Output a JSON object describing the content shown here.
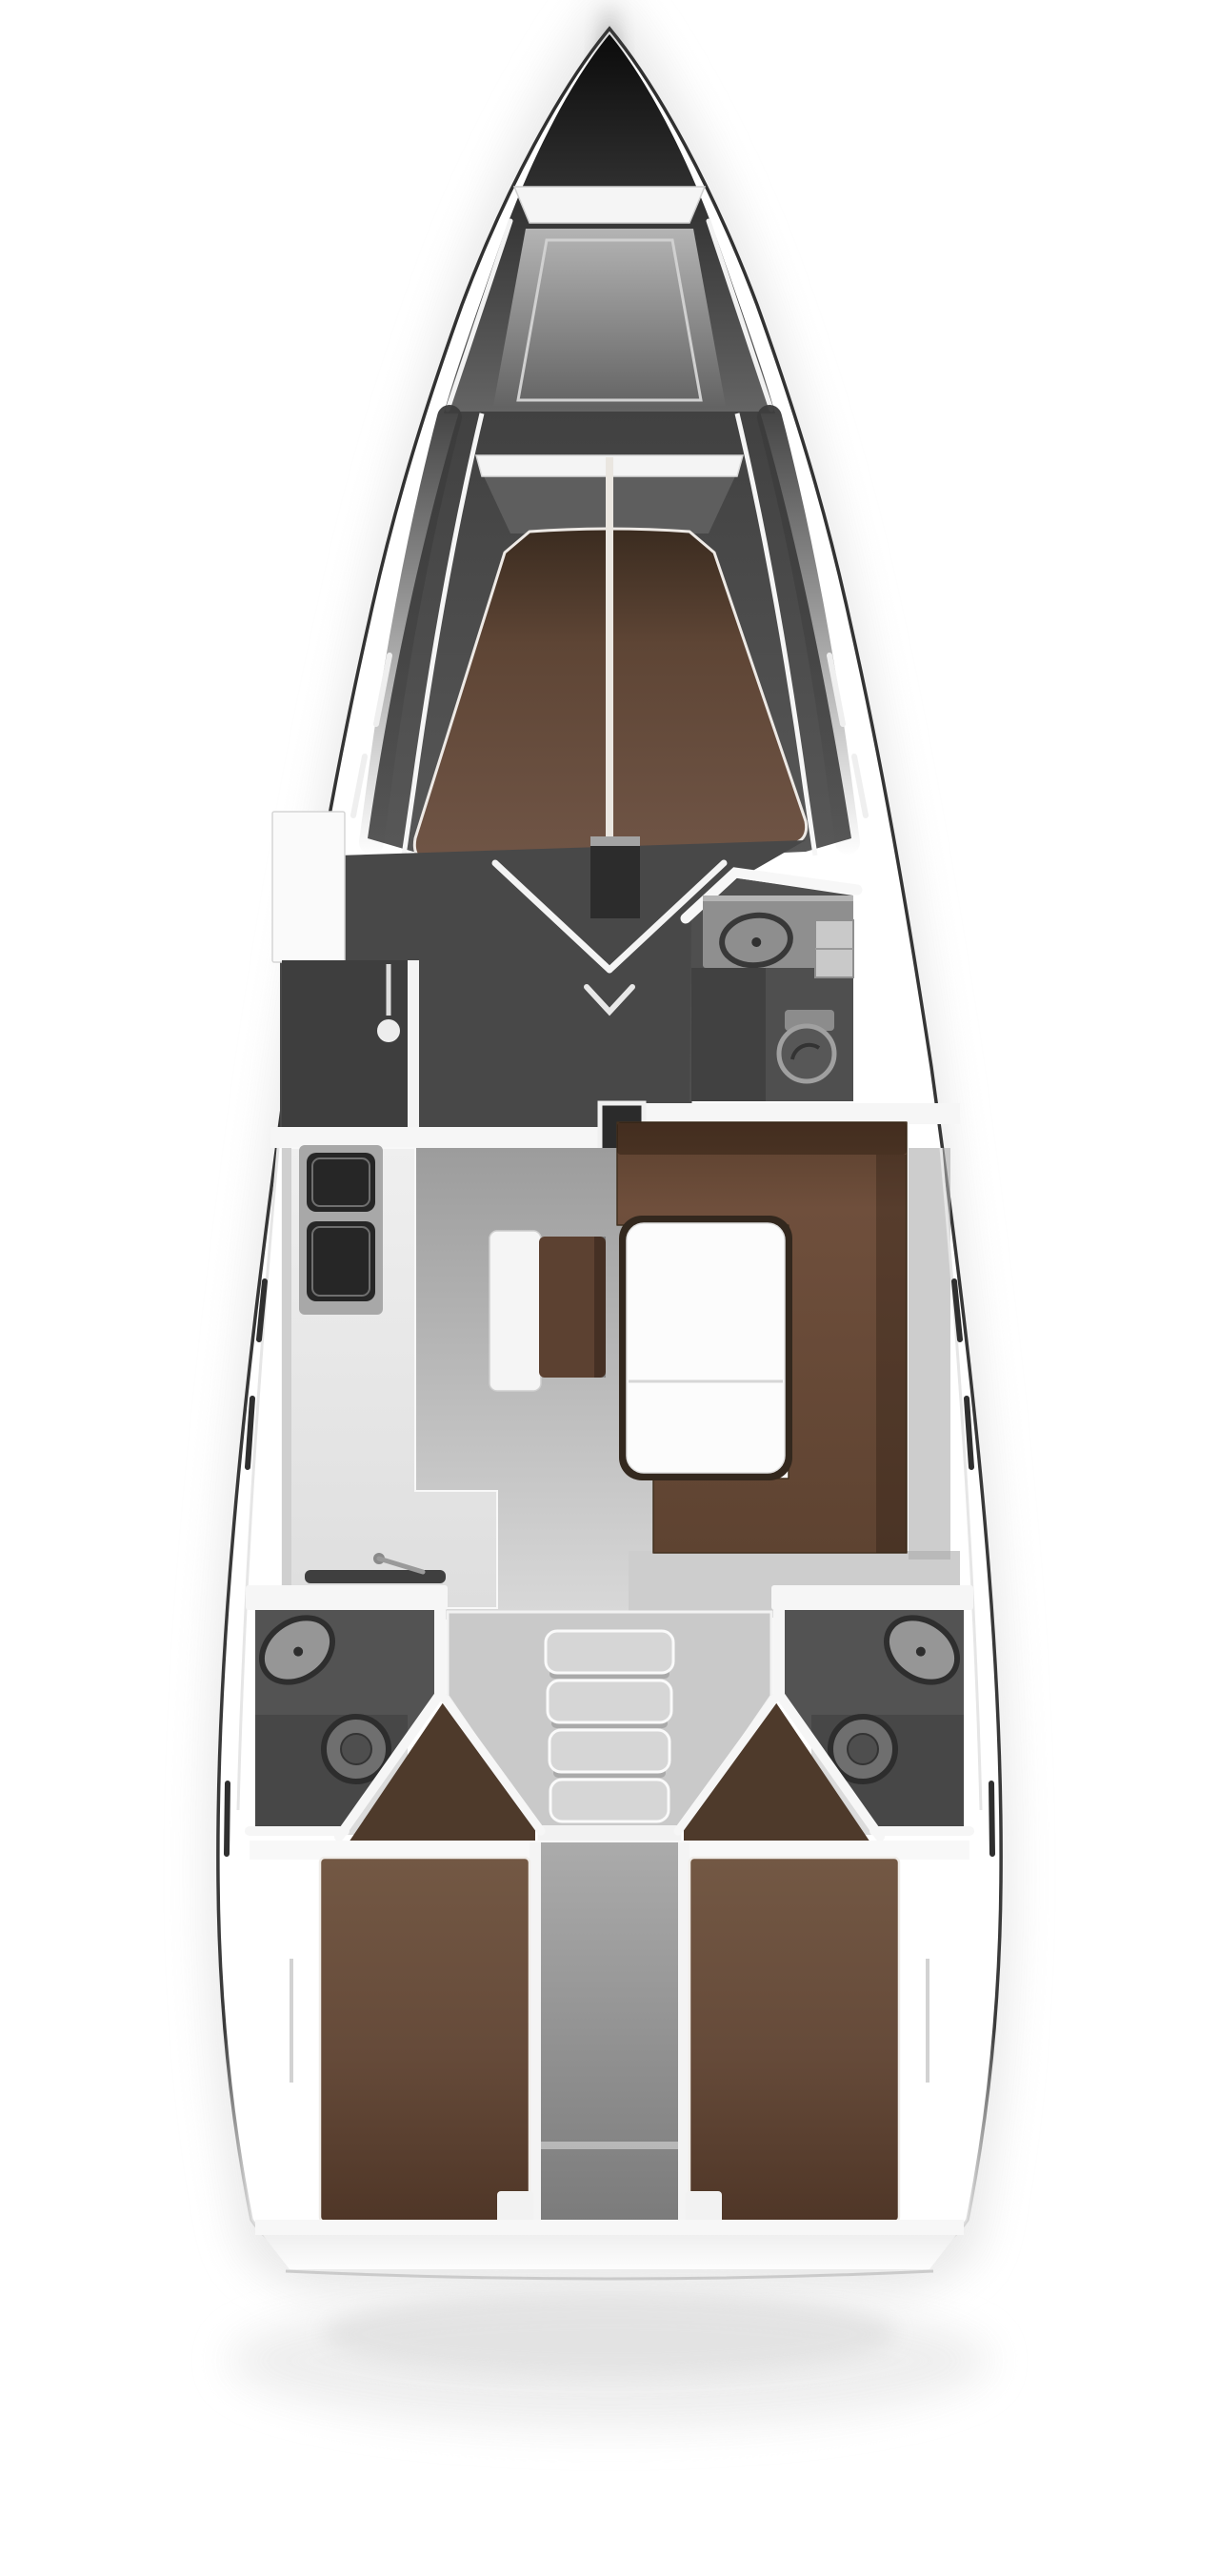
{
  "meta": {
    "type": "yacht-interior-floor-plan",
    "view": "top-down",
    "orientation": "bow-up"
  },
  "colors": {
    "background": "#ffffff",
    "hull_line": "#303030",
    "bow_dark": "#0b0b0b",
    "bow_fade": "#656565",
    "locker_top": "#b4b4b4",
    "locker_bottom": "#636363",
    "wall_white": "#f6f6f6",
    "cabin_dark_top": "#414141",
    "cabin_dark_bottom": "#585858",
    "mid_floor_dark": "#484848",
    "closet_dark": "#3e3e3e",
    "head_interior": "#4f4f4f",
    "aft_head_interior": "#535353",
    "fwd_berth_top": "#3a2b1f",
    "fwd_berth_mid": "#5e4535",
    "fwd_berth_bottom": "#705546",
    "berth_seam": "#eae6e0",
    "floor_top": "#9c9c9c",
    "floor_bottom": "#d9d9d9",
    "counter_top": "#efefef",
    "counter_bottom": "#dedede",
    "stove_dark": "#262626",
    "settee_top": "#5a3f2d",
    "settee_mid": "#6f4f3c",
    "settee_bottom": "#5e4331",
    "table_frame": "#33281e",
    "table_top": "#fcfcfc",
    "bench_white": "#f5f5f5",
    "bench_brown": "#5c4131",
    "bay_floor": "#c9c9c9",
    "step_gray": "#d6d6d6",
    "corridor_top": "#ababab",
    "corridor_bottom": "#7b7b7b",
    "aft_berth_top": "#735844",
    "aft_berth_mid": "#654a39",
    "aft_berth_bottom": "#4f3627",
    "entry_brown": "#4e3a2b",
    "fixture_ring": "#2d2d2d",
    "fixture_fill": "#8e8e8e",
    "toilet_fill": "#6f6f6f",
    "window_dark": "#2f2f2f",
    "window_light": "#efefef",
    "transom_line": "#c6c6c6",
    "soft_shadow": "#e8e8e8"
  },
  "regions": {
    "bow": {
      "name": "bow with windlass plate and anchor locker"
    },
    "forward_cabin": {
      "name": "forward cabin",
      "berth": "V-shaped island double berth with center seam",
      "wardrobe": "port wardrobe",
      "hanging_locker": "port hanging locker with hanger symbol"
    },
    "forward_head": {
      "name": "forward head (starboard)",
      "fixtures": [
        "sink",
        "vanity-cabinet",
        "toilet"
      ]
    },
    "saloon": {
      "name": "saloon",
      "furniture": [
        "L-shaped settee (starboard)",
        "folding table",
        "center bench seat"
      ]
    },
    "galley": {
      "name": "galley (port)",
      "fixtures": [
        "two-burner stove",
        "sink",
        "faucet"
      ]
    },
    "companionway": {
      "name": "companionway",
      "step_count": 4
    },
    "aft_head_port": {
      "name": "aft head (port)",
      "fixtures": [
        "sink",
        "toilet"
      ]
    },
    "aft_head_starboard": {
      "name": "aft head (starboard)",
      "fixtures": [
        "sink",
        "toilet"
      ]
    },
    "aft_cabin_port": {
      "name": "aft cabin (port)",
      "berth": "double berth"
    },
    "aft_cabin_starboard": {
      "name": "aft cabin (starboard)",
      "berth": "double berth"
    },
    "engine_corridor": {
      "name": "center corridor / engine compartment"
    },
    "stern": {
      "name": "transom platform with soft drop shadow"
    }
  },
  "hull_windows": {
    "port_count": 5,
    "starboard_count": 5
  }
}
